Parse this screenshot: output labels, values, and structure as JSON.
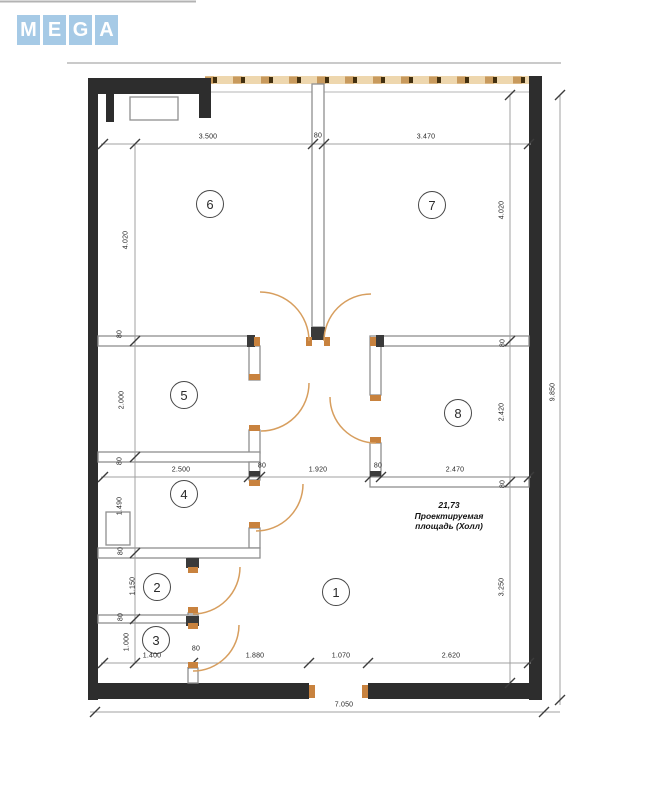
{
  "logo": {
    "tiles": [
      {
        "letter": "M"
      },
      {
        "letter": "E"
      },
      {
        "letter": "G"
      },
      {
        "letter": "A"
      }
    ],
    "tile_color": "#a6cae6",
    "letter_color": "#ffffff"
  },
  "plan": {
    "annotation": {
      "area": "21,73",
      "line2": "Проектируемая",
      "line3": "площадь (Холл)"
    },
    "rooms": [
      {
        "label": "1",
        "x": 336,
        "y": 592
      },
      {
        "label": "2",
        "x": 157,
        "y": 587
      },
      {
        "label": "3",
        "x": 156,
        "y": 640
      },
      {
        "label": "4",
        "x": 184,
        "y": 494
      },
      {
        "label": "5",
        "x": 184,
        "y": 395
      },
      {
        "label": "6",
        "x": 210,
        "y": 204
      },
      {
        "label": "7",
        "x": 432,
        "y": 205
      },
      {
        "label": "8",
        "x": 458,
        "y": 413
      }
    ],
    "dimensions": [
      {
        "text": "3.500",
        "x": 208,
        "y": 137
      },
      {
        "text": "80",
        "x": 318,
        "y": 136
      },
      {
        "text": "3.470",
        "x": 426,
        "y": 137
      },
      {
        "text": "4.020",
        "x": 126,
        "y": 240,
        "rot": true
      },
      {
        "text": "80",
        "x": 120,
        "y": 334,
        "rot": true
      },
      {
        "text": "2.000",
        "x": 122,
        "y": 400,
        "rot": true
      },
      {
        "text": "80",
        "x": 120,
        "y": 461,
        "rot": true
      },
      {
        "text": "1.490",
        "x": 120,
        "y": 506,
        "rot": true
      },
      {
        "text": "80",
        "x": 121,
        "y": 551,
        "rot": true
      },
      {
        "text": "1.150",
        "x": 133,
        "y": 586,
        "rot": true
      },
      {
        "text": "80",
        "x": 121,
        "y": 617,
        "rot": true
      },
      {
        "text": "1.000",
        "x": 127,
        "y": 642,
        "rot": true
      },
      {
        "text": "2.500",
        "x": 181,
        "y": 470
      },
      {
        "text": "80",
        "x": 262,
        "y": 466
      },
      {
        "text": "1.920",
        "x": 318,
        "y": 470
      },
      {
        "text": "80",
        "x": 378,
        "y": 466
      },
      {
        "text": "2.470",
        "x": 455,
        "y": 470
      },
      {
        "text": "4.020",
        "x": 502,
        "y": 210,
        "rot": true
      },
      {
        "text": "80",
        "x": 503,
        "y": 343,
        "rot": true
      },
      {
        "text": "2.420",
        "x": 502,
        "y": 412,
        "rot": true
      },
      {
        "text": "80",
        "x": 503,
        "y": 484,
        "rot": true
      },
      {
        "text": "3.250",
        "x": 502,
        "y": 587,
        "rot": true
      },
      {
        "text": "1.400",
        "x": 152,
        "y": 656
      },
      {
        "text": "80",
        "x": 196,
        "y": 649
      },
      {
        "text": "1.880",
        "x": 255,
        "y": 656
      },
      {
        "text": "1.070",
        "x": 341,
        "y": 656
      },
      {
        "text": "2.620",
        "x": 451,
        "y": 656
      },
      {
        "text": "9.850",
        "x": 553,
        "y": 392,
        "rot": true
      },
      {
        "text": "7.050",
        "x": 344,
        "y": 705
      }
    ]
  },
  "colors": {
    "outer_wall": "#2d2d2d",
    "interior_wall_stroke": "#8f8f8f",
    "door_arc": "#d79e5e",
    "door_jamb": "#c8823e",
    "dashed_line_tan": "#eed7ae",
    "dimension_line": "#a0a0a0",
    "logo_blue": "#a6cae6"
  }
}
